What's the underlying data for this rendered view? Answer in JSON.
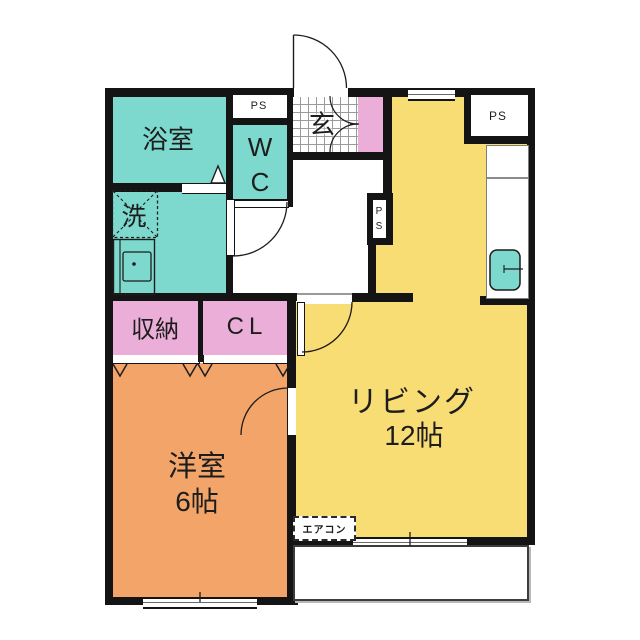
{
  "title": "1LDK apartment floor plan",
  "colors": {
    "teal": "#7dd9cd",
    "pink": "#ebaed8",
    "yellow": "#f8dc74",
    "orange": "#f2a469",
    "wall": "#141414",
    "grid_line": "#9a9a9a",
    "text": "#1d1d1d"
  },
  "rooms": {
    "bath": {
      "label": "浴室"
    },
    "laundry": {
      "label": "洗"
    },
    "wc": {
      "label": "WC"
    },
    "genkan": {
      "label": "玄"
    },
    "storage": {
      "label": "収納"
    },
    "closet": {
      "label": "CL"
    },
    "living": {
      "label": "リビング",
      "size": "12帖"
    },
    "western_room": {
      "label": "洋室",
      "size": "6帖"
    }
  },
  "labels": {
    "ps_top_left": "PS",
    "ps_top_right": "PS",
    "ps_middle": "PS",
    "aircon": "エアコン"
  }
}
